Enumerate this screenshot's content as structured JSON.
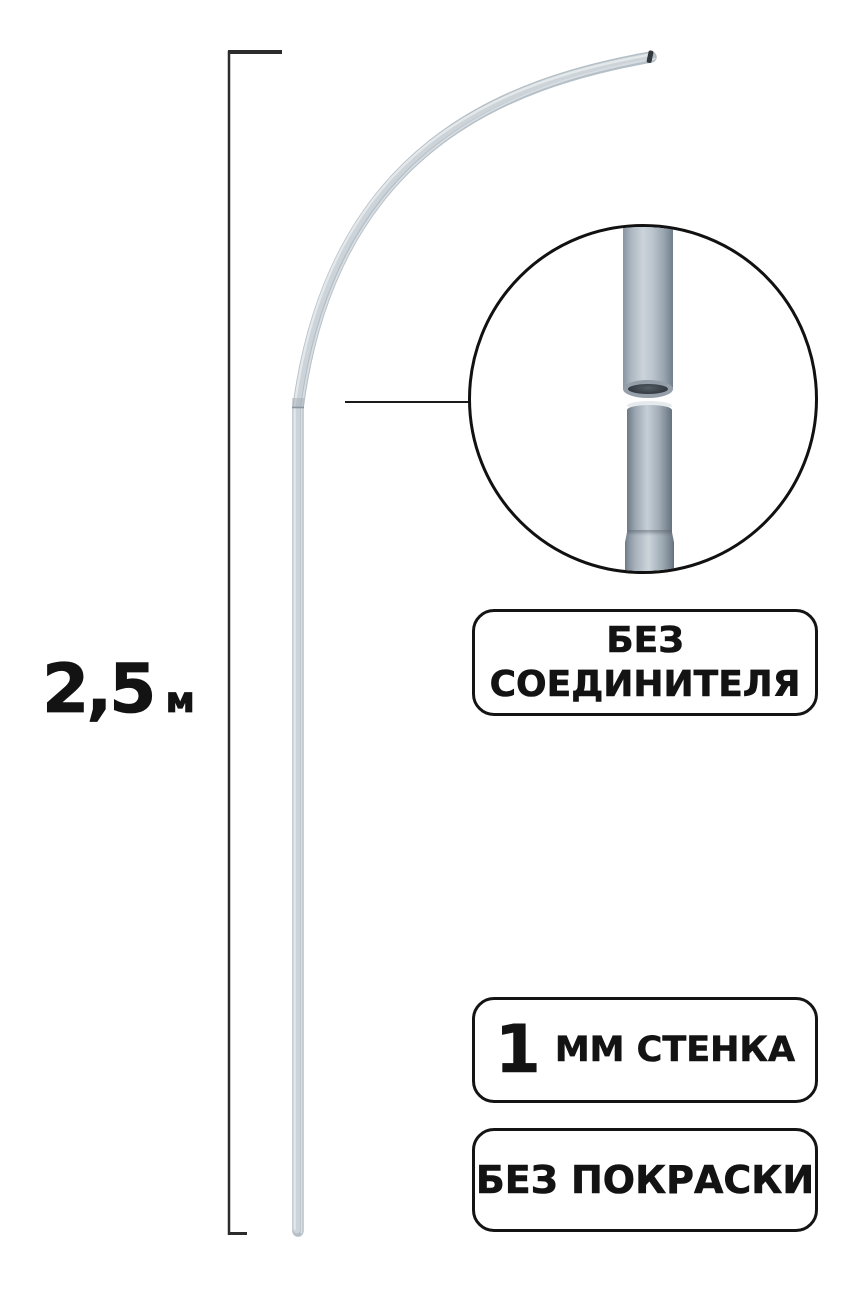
{
  "dimension": {
    "value": "2,5",
    "unit": "м"
  },
  "badges": {
    "connector": {
      "line1": "БЕЗ",
      "line2": "СОЕДИНИТЕЛЯ"
    },
    "wall_thickness": {
      "number": "1",
      "label": "ММ СТЕНКА"
    },
    "paint": {
      "label": "БЕЗ ПОКРАСКИ"
    }
  },
  "colors": {
    "background": "#ffffff",
    "outline": "#141414",
    "text": "#131313",
    "pole_silver": "#b4bfc7",
    "pole_highlight": "#e4e8ea",
    "steel_pipe_light": "#ccd4da",
    "steel_pipe_dark": "#6d7a86"
  }
}
